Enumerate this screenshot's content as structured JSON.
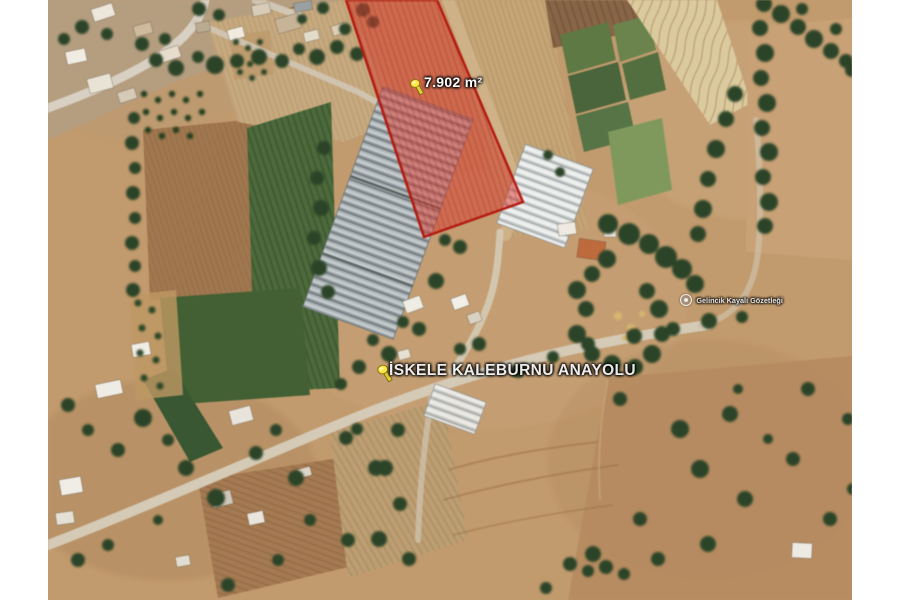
{
  "map_labels": {
    "parcel_area": "7.902 m²",
    "road_name": "İSKELE KALEBURNU ANAYOLU",
    "place_watermark": "Gelincik Kayalı Gözetleği"
  },
  "parcel": {
    "points": "298,0 389,0 475,202 376,237",
    "fill": "#e23b2e",
    "fill_opacity": "0.52",
    "stroke": "#bf1a10",
    "stroke_width": "2.5"
  },
  "colors": {
    "terrain_base": "#c49a69",
    "field_green": "#4a6b38",
    "road": "#d5cab4",
    "tree": "#2b4426",
    "pushpin": "#ffe83d",
    "margin": "#ffffff"
  }
}
